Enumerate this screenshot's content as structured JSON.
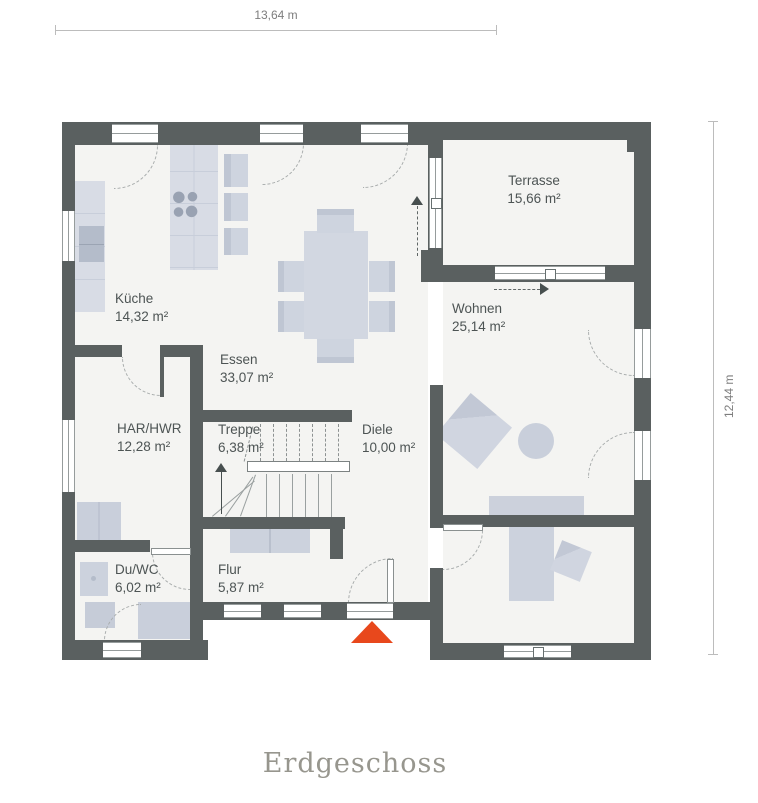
{
  "title": "Erdgeschoss",
  "dimensions": {
    "width": "13,64 m",
    "height": "12,44 m"
  },
  "rooms": {
    "terrasse": {
      "name": "Terrasse",
      "area": "15,66 m²"
    },
    "kueche": {
      "name": "Küche",
      "area": "14,32 m²"
    },
    "essen": {
      "name": "Essen",
      "area": "33,07 m²"
    },
    "wohnen": {
      "name": "Wohnen",
      "area": "25,14 m²"
    },
    "har_hwr": {
      "name": "HAR/HWR",
      "area": "12,28 m²"
    },
    "treppe": {
      "name": "Treppe",
      "area": "6,38 m²"
    },
    "diele": {
      "name": "Diele",
      "area": "10,00 m²"
    },
    "du_wc": {
      "name": "Du/WC",
      "area": "6,02 m²"
    },
    "flur": {
      "name": "Flur",
      "area": "5,87 m²"
    }
  },
  "colors": {
    "wall": "#5a6060",
    "floor": "#f4f4f2",
    "furniture": "#d2d7e1",
    "entrance_marker": "#e8481c"
  }
}
